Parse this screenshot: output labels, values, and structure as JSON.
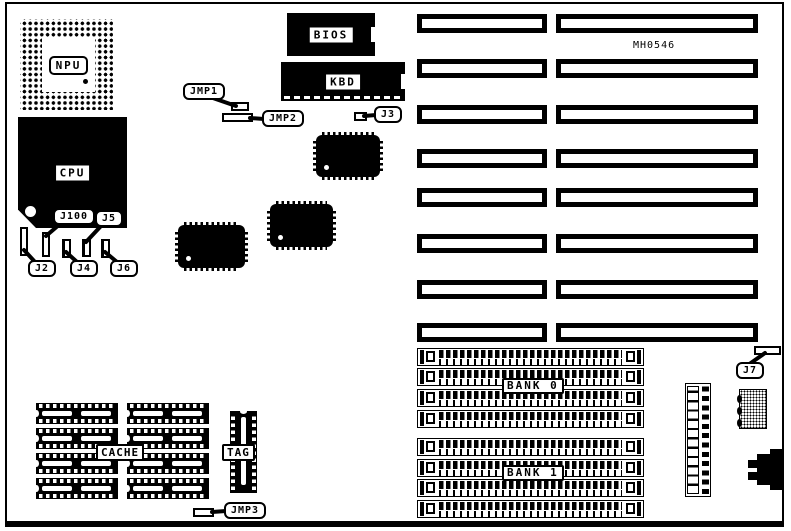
{
  "board": {
    "part_number": "MH0546",
    "chips": {
      "npu": "NPU",
      "cpu": "CPU",
      "bios": "BIOS",
      "kbd": "KBD"
    },
    "memory": {
      "bank0": "BANK 0",
      "bank1": "BANK 1"
    },
    "cache": {
      "cache": "CACHE",
      "tag": "TAG"
    },
    "jumpers": {
      "jmp1": "JMP1",
      "jmp2": "JMP2",
      "jmp3": "JMP3",
      "j2": "J2",
      "j3": "J3",
      "j4": "J4",
      "j5": "J5",
      "j6": "J6",
      "j7": "J7",
      "j100": "J100"
    }
  }
}
